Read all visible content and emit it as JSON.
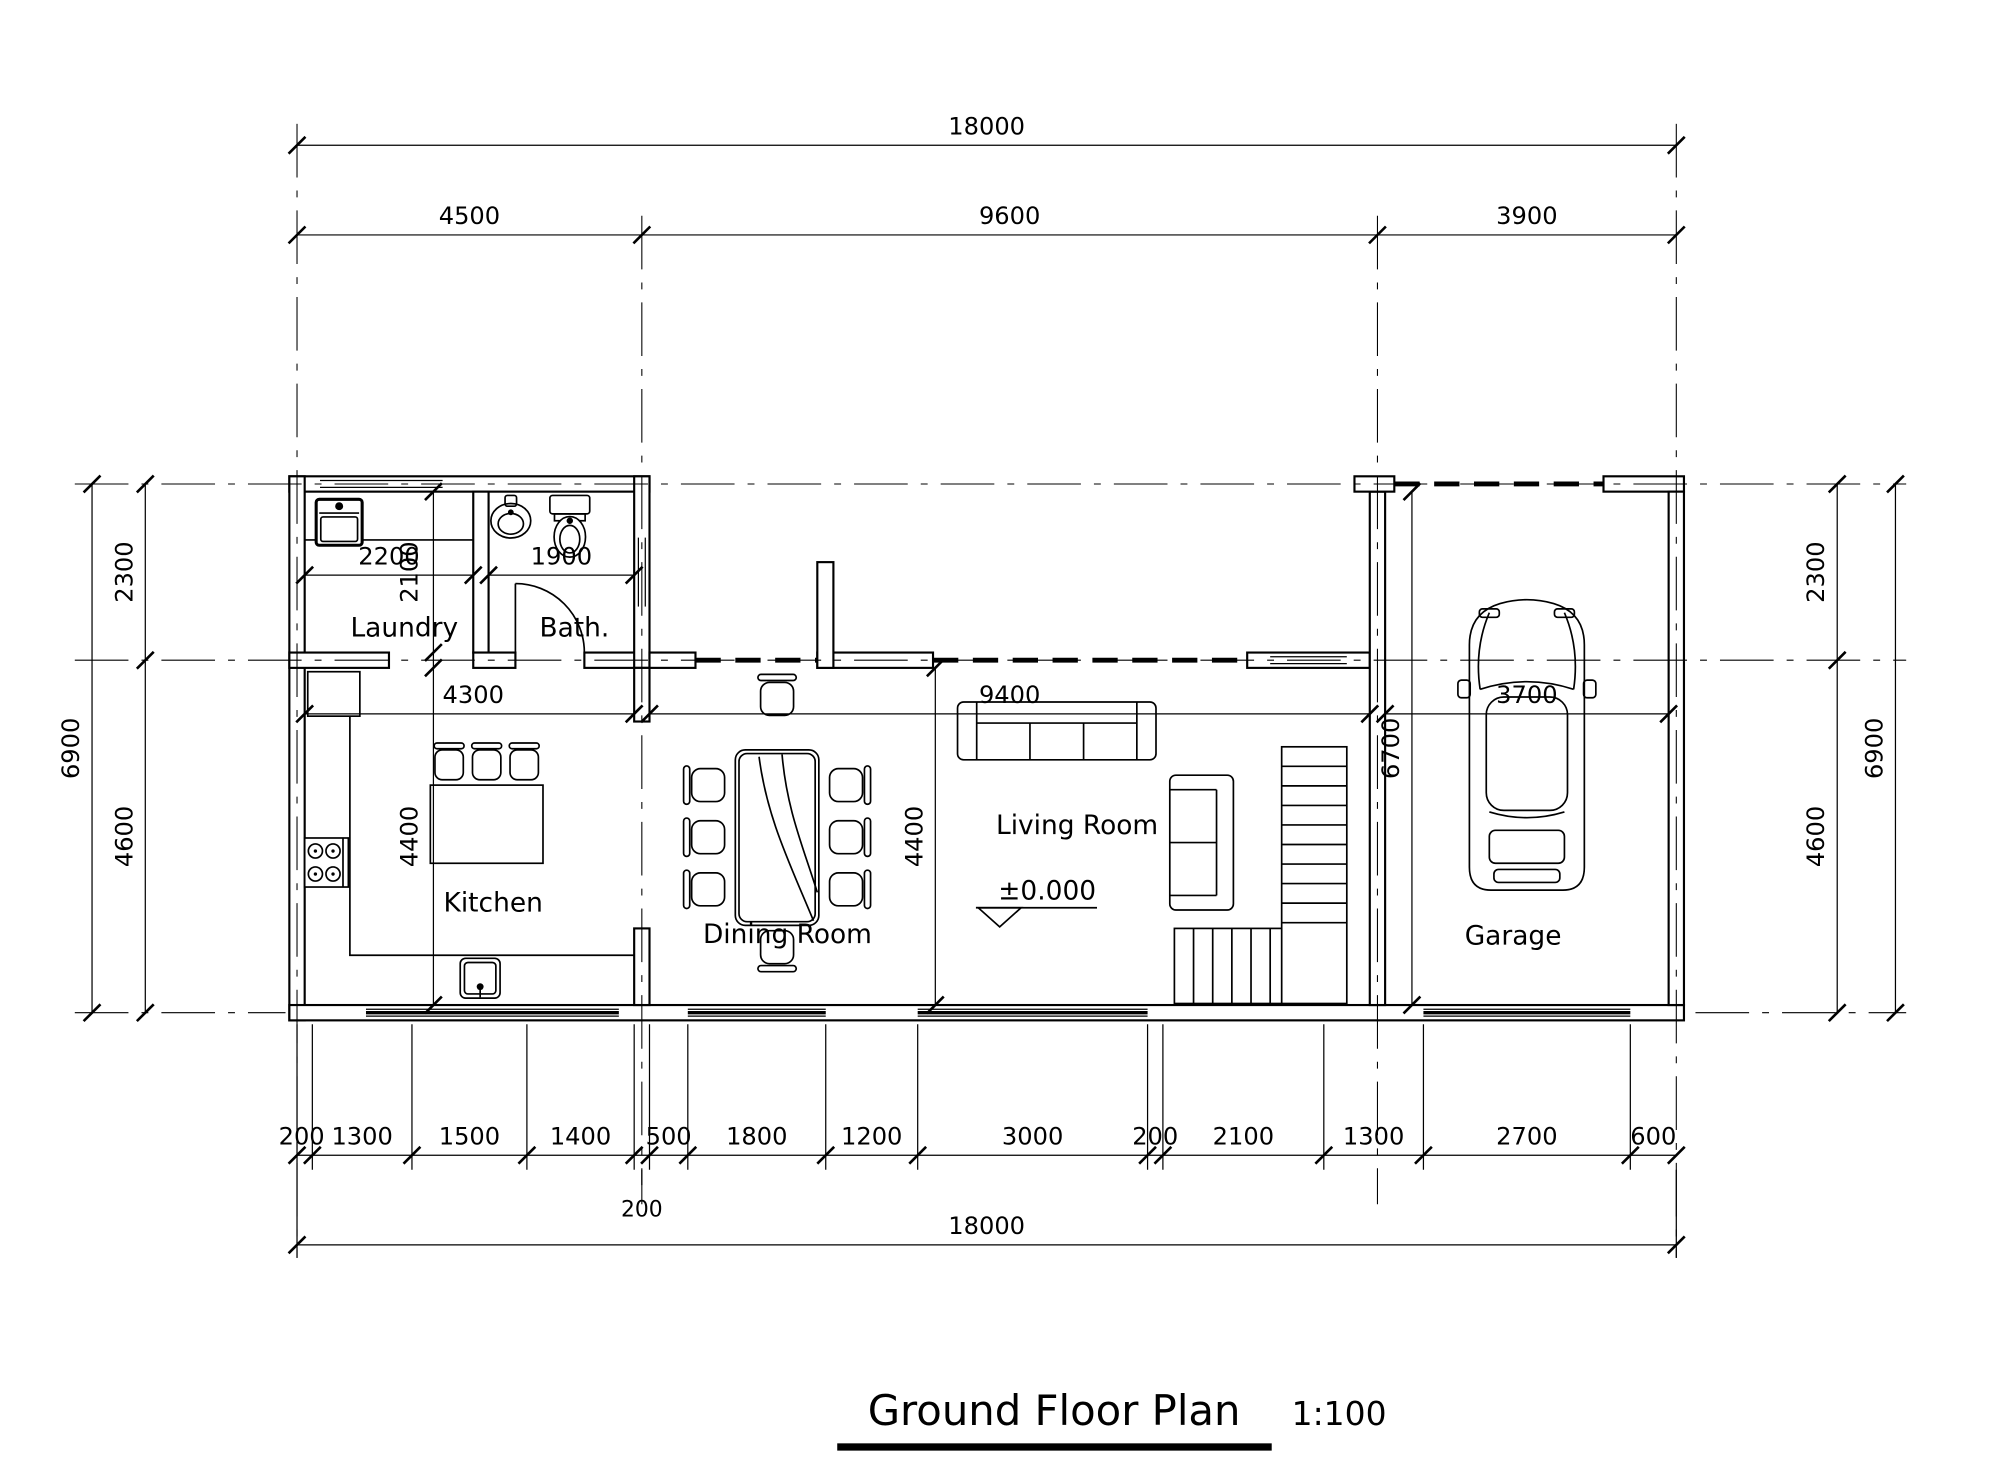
{
  "drawing": {
    "title": "Ground Floor Plan",
    "scale": "1:100",
    "line_color": "#000000",
    "background": "#ffffff"
  },
  "rooms": {
    "laundry": "Laundry",
    "bath": "Bath.",
    "kitchen": "Kitchen",
    "dining": "Dining Room",
    "living": "Living Room",
    "garage": "Garage"
  },
  "annotations": {
    "level": "±0.000"
  },
  "dims": {
    "top_overall": "18000",
    "top_segments": [
      "4500",
      "9600",
      "3900"
    ],
    "bottom_chain": [
      "200",
      "1300",
      "1500",
      "1400",
      "200",
      "500",
      "1800",
      "1200",
      "3000",
      "200",
      "2100",
      "1300",
      "2700",
      "600"
    ],
    "bottom_overall": "18000",
    "left": {
      "outer": "6900",
      "inner": [
        "2300",
        "4600"
      ]
    },
    "right": {
      "outer": "6900",
      "inner": [
        "2300",
        "4600"
      ]
    },
    "interior": {
      "laundry_width": "2200",
      "laundry_height": "2100",
      "bath_width": "1900",
      "kitchen_width": "4300",
      "kitchen_height": "4400",
      "dining_height": "4400",
      "dining_living_width": "9400",
      "garage_width": "3700",
      "garage_height": "6700"
    }
  }
}
